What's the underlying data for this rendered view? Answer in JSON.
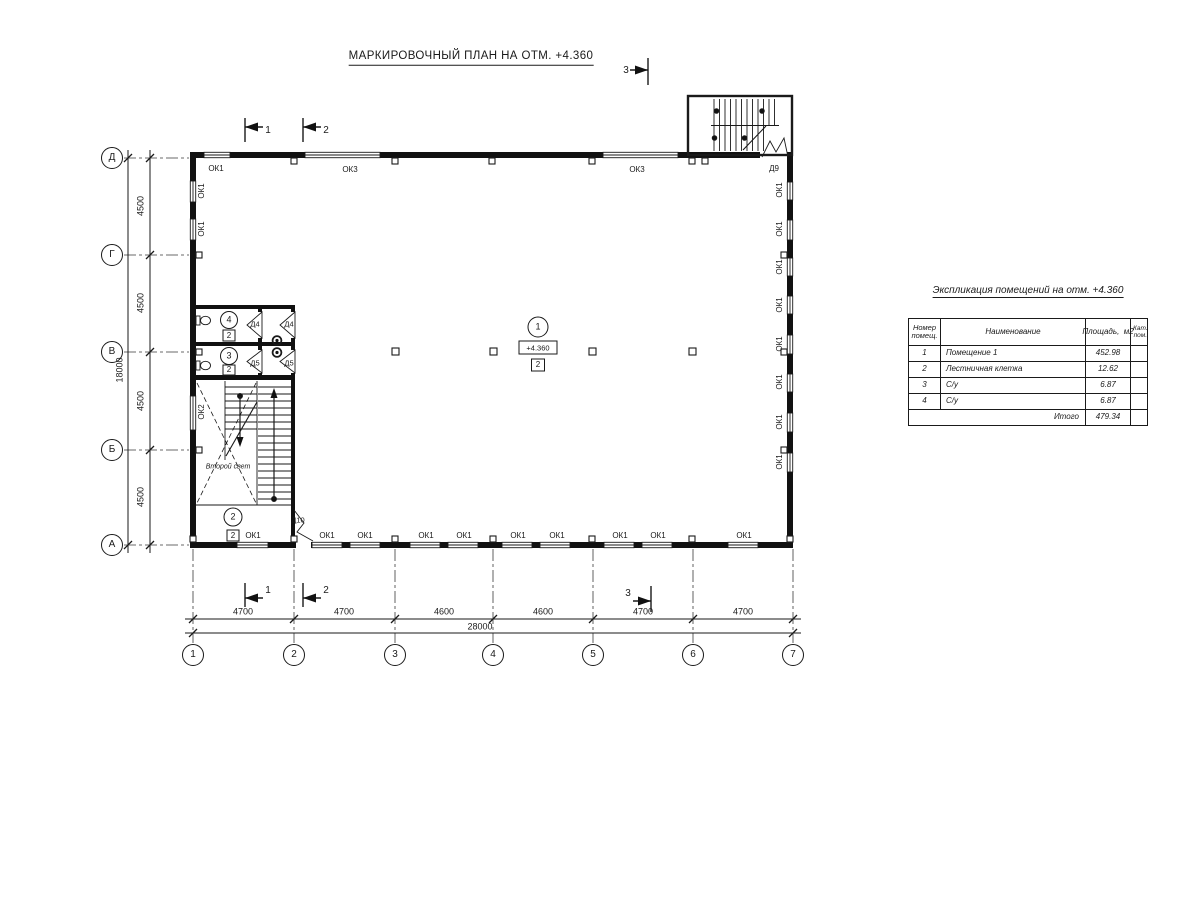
{
  "title": "МАРКИРОВОЧНЫЙ ПЛАН НА ОТМ. +4.360",
  "axes": {
    "letters": [
      "Д",
      "Г",
      "В",
      "Б",
      "А"
    ],
    "numbers": [
      "1",
      "2",
      "3",
      "4",
      "5",
      "6",
      "7"
    ]
  },
  "dims": {
    "h_segments": [
      "4700",
      "4700",
      "4600",
      "4600",
      "4700",
      "4700"
    ],
    "h_total": "28000",
    "v_segments": [
      "4500",
      "4500",
      "4500",
      "4500"
    ],
    "v_total": "18000"
  },
  "markers": {
    "m1": "1",
    "m2": "2",
    "m3": "3"
  },
  "windows": {
    "top": [
      "ОК1",
      "ОК3",
      "ОК3"
    ],
    "bottom": [
      "ОК1",
      "ОК1",
      "ОК1",
      "ОК1",
      "ОК1",
      "ОК1",
      "ОК1",
      "ОК1",
      "ОК1",
      "ОК1"
    ],
    "left": [
      "ОК1",
      "ОК1",
      "ОК2"
    ],
    "right": [
      "ОК1",
      "ОК1",
      "ОК1",
      "ОК1",
      "ОК1",
      "ОК1",
      "ОК1",
      "ОК1"
    ]
  },
  "doors": {
    "d4": "Д4",
    "d5": "Д5",
    "d9": "Д9",
    "d10": "Д10"
  },
  "rooms": {
    "r1": "1",
    "r2": "2",
    "r3": "3",
    "r4": "4",
    "elevation": "+4.360",
    "category": "2",
    "second_light": "Второй свет"
  },
  "schedule": {
    "title": "Экспликация помещений на отм. +4.360",
    "headers": {
      "number": "Номер помещ.",
      "name": "Наименование",
      "area": "Площадь,  м2",
      "category": "Кат. пом."
    },
    "rows": [
      {
        "number": "1",
        "name": "Помещение 1",
        "area": "452.98",
        "category": ""
      },
      {
        "number": "2",
        "name": "Лестничная клетка",
        "area": "12.62",
        "category": ""
      },
      {
        "number": "3",
        "name": "С/у",
        "area": "6.87",
        "category": ""
      },
      {
        "number": "4",
        "name": "С/у",
        "area": "6.87",
        "category": ""
      }
    ],
    "total_label": "Итого",
    "total_value": "479.34"
  }
}
